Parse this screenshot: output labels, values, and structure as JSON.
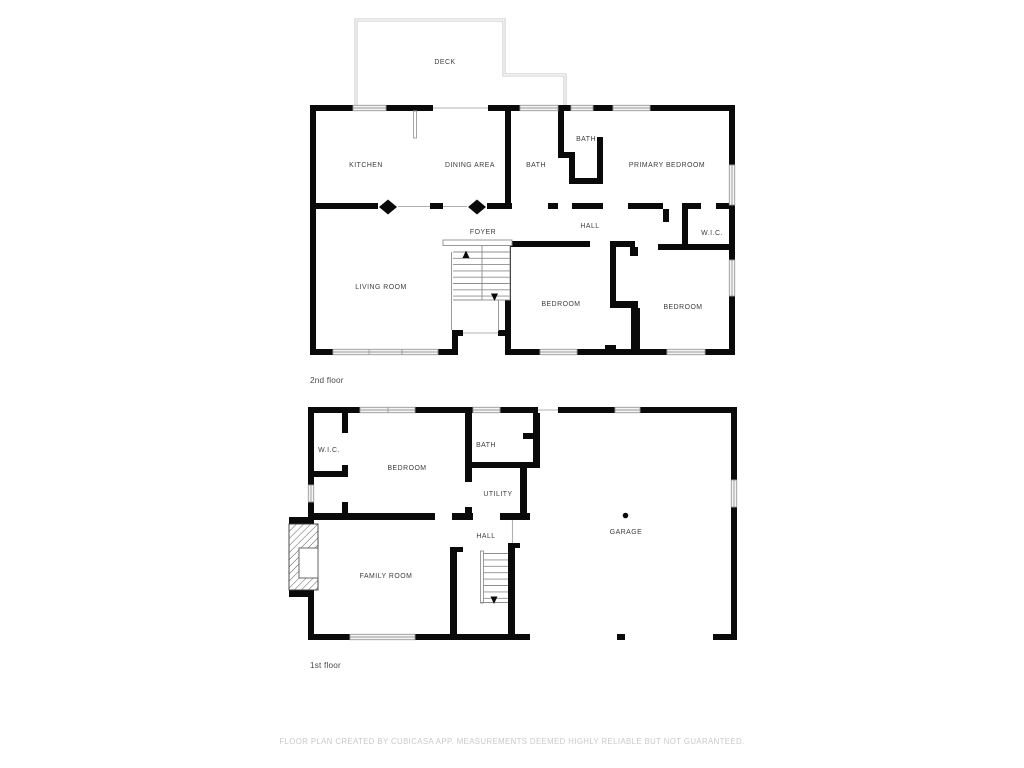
{
  "page": {
    "background": "#ffffff"
  },
  "floor2": {
    "label": "2nd floor",
    "rooms": {
      "deck": "DECK",
      "kitchen": "KITCHEN",
      "dining_area": "DINING AREA",
      "bath_hall": "BATH",
      "bath_ensuite": "BATH",
      "primary_bedroom": "PRIMARY BEDROOM",
      "hall": "HALL",
      "wic": "W.I.C.",
      "foyer": "FOYER",
      "living_room": "LIVING ROOM",
      "bedroom_a": "BEDROOM",
      "bedroom_b": "BEDROOM"
    }
  },
  "floor1": {
    "label": "1st floor",
    "rooms": {
      "wic": "W.I.C.",
      "bedroom": "BEDROOM",
      "bath": "BATH",
      "utility": "UTILITY",
      "hall": "HALL",
      "garage": "GARAGE",
      "family_room": "FAMILY ROOM"
    }
  },
  "footer": {
    "disclaimer": "FLOOR PLAN CREATED BY CUBICASA APP. MEASUREMENTS DEEMED HIGHLY RELIABLE BUT NOT GUARANTEED."
  },
  "colors": {
    "wall": "#0a0a0a",
    "window_fill": "#f4f4f4",
    "window_stroke": "#9a9a9a",
    "thin_line": "#b0b0b0",
    "room_label": "#3d3d3d",
    "floor_label": "#4a4a4a",
    "footer_text": "#c9c9c9"
  }
}
